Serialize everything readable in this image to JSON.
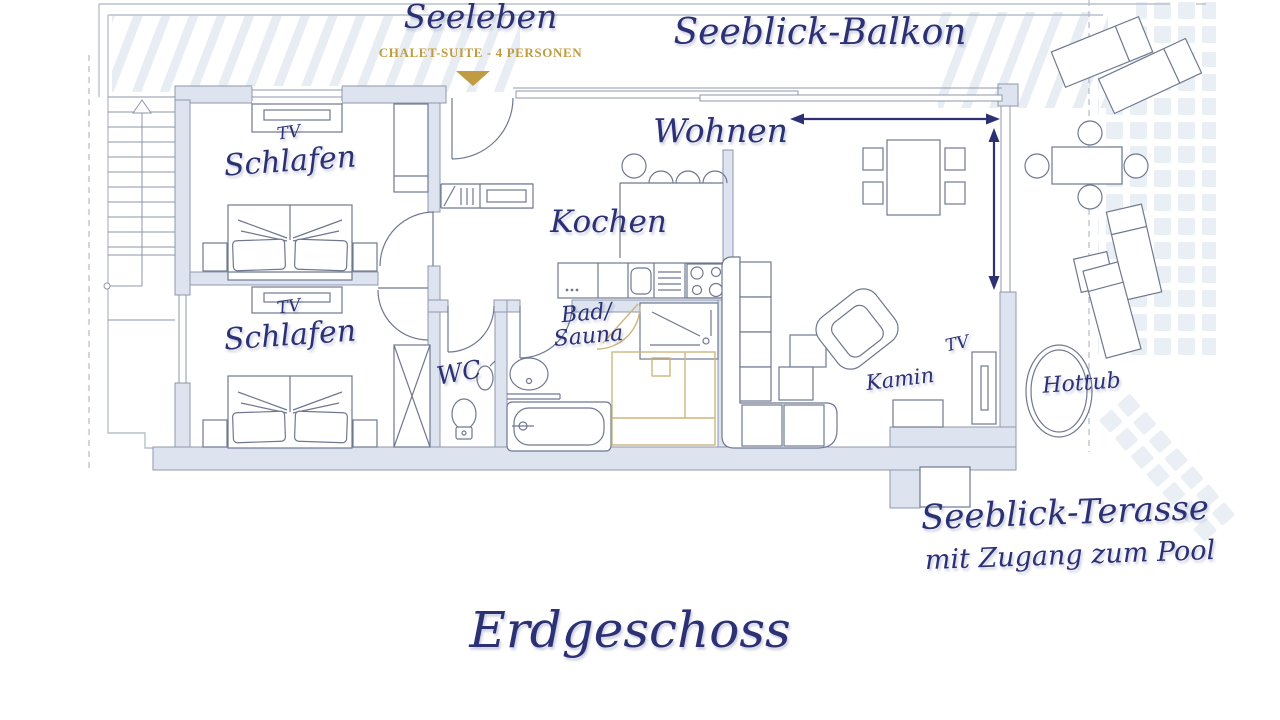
{
  "header": {
    "suite_name": "Seeleben",
    "suite_subtitle": "CHALET-SUITE - 4 PERSONEN"
  },
  "labels": {
    "balcony": "Seeblick-Balkon",
    "living": "Wohnen",
    "kitchen": "Kochen",
    "bedroom1": "Schlafen",
    "bedroom1_tv": "TV",
    "bedroom2": "Schlafen",
    "bedroom2_tv": "TV",
    "bath_line1": "Bad/",
    "bath_line2": "Sauna",
    "wc": "WC",
    "fireplace": "Kamin",
    "living_tv": "TV",
    "hottub": "Hottub",
    "terrace": "Seeblick-Terasse",
    "terrace_sub": "mit Zugang zum Pool",
    "floor": "Erdgeschoss"
  },
  "colors": {
    "navy": "#2b3173",
    "gold": "#bf9b41",
    "sauna-gold": "#cdb67c",
    "wall-fill": "#dde4ef",
    "wall-stroke": "#8e97ac",
    "furniture": "#6f7890",
    "outline": "#b9c0cc"
  }
}
